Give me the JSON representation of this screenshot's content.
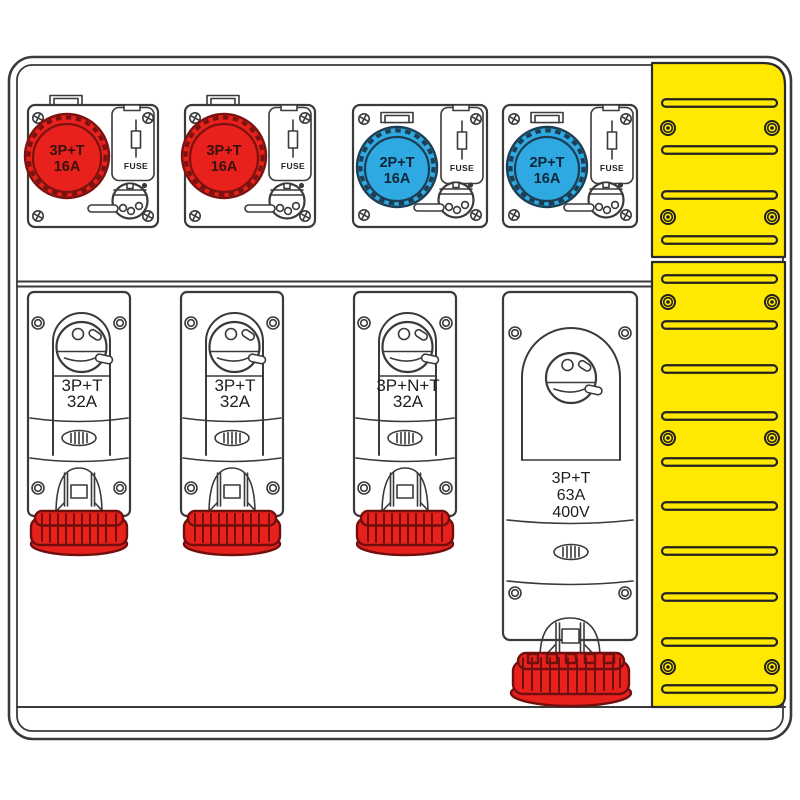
{
  "diagram_title": "distribution-board-with-cee-sockets",
  "colors": {
    "socket_red": "#e8211d",
    "socket_red_outline": "#7a120f",
    "socket_blue": "#2fa9e1",
    "socket_blue_outline": "#1d3d52",
    "duct_yellow": "#ffe900",
    "line": "#3a3a3a",
    "background": "#ffffff"
  },
  "top_units": [
    {
      "color": "red",
      "line1": "3P+T",
      "line2": "16A",
      "fuse": "FUSE"
    },
    {
      "color": "red",
      "line1": "3P+T",
      "line2": "16A",
      "fuse": "FUSE"
    },
    {
      "color": "blue",
      "line1": "2P+T",
      "line2": "16A",
      "fuse": "FUSE"
    },
    {
      "color": "blue",
      "line1": "2P+T",
      "line2": "16A",
      "fuse": "FUSE"
    }
  ],
  "bottom_units": [
    {
      "line1": "3P+T",
      "line2": "32A"
    },
    {
      "line1": "3P+T",
      "line2": "32A"
    },
    {
      "line1": "3P+N+T",
      "line2": "32A"
    },
    {
      "line1": "3P+T",
      "line2": "63A",
      "line3": "400V"
    }
  ]
}
